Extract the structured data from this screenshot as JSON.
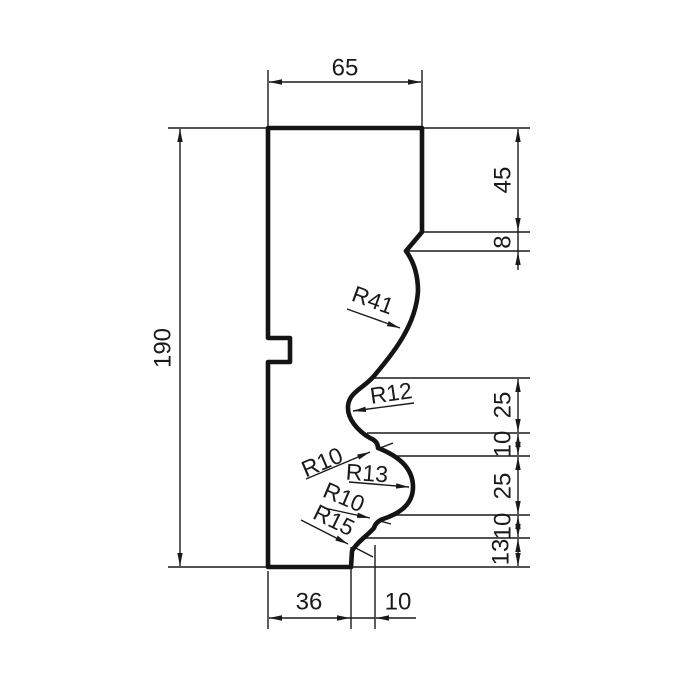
{
  "drawing": {
    "type": "technical-profile-drawing",
    "colors": {
      "line": "#1a1a1a",
      "background": "#ffffff"
    },
    "dims": {
      "width_top": "65",
      "height_left": "190",
      "right_45": "45",
      "right_8": "8",
      "right_25a": "25",
      "right_10a": "10",
      "right_25b": "25",
      "right_10b": "10",
      "right_13": "13",
      "bottom_36": "36",
      "bottom_10": "10"
    },
    "radii": {
      "r41": "R41",
      "r12": "R12",
      "r10_upper": "R10",
      "r13": "R13",
      "r10_lower": "R10",
      "r15": "R15"
    }
  }
}
